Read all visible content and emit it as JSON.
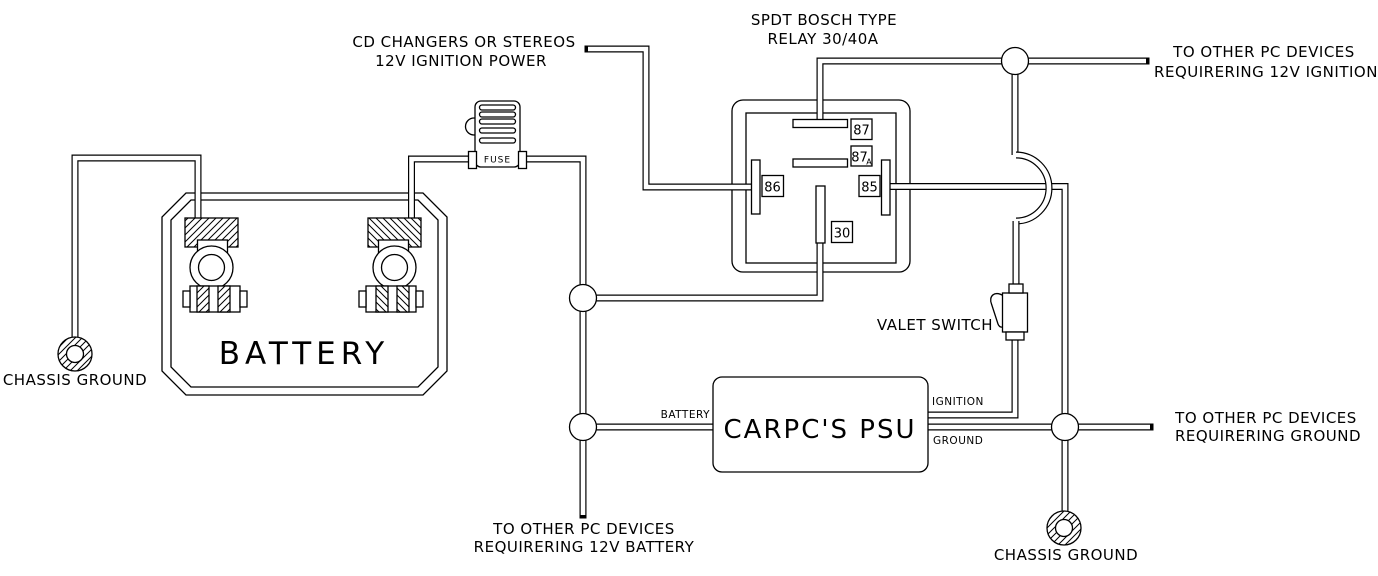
{
  "diagram": {
    "type": "car-pc-power-wiring-diagram",
    "background_color": "#ffffff",
    "line_color": "#000000"
  },
  "labels": {
    "cd_source_line1": "CD CHANGERS OR STEREOS",
    "cd_source_line2": "12V IGNITION POWER",
    "relay_title_line1": "SPDT BOSCH TYPE",
    "relay_title_line2": "RELAY 30/40A",
    "ignition_devices_line1": "TO OTHER PC DEVICES",
    "ignition_devices_line2": "REQUIRERING 12V IGNITION",
    "ground_devices_line1": "TO OTHER PC DEVICES",
    "ground_devices_line2": "REQUIRERING GROUND",
    "battery_devices_line1": "TO OTHER PC DEVICES",
    "battery_devices_line2": "REQUIRERING 12V BATTERY",
    "chassis_ground_left": "CHASSIS GROUND",
    "chassis_ground_right": "CHASSIS GROUND",
    "battery_label": "BATTERY",
    "fuse_label": "FUSE",
    "valet_switch_label": "VALET SWITCH",
    "psu_label": "CARPC'S PSU",
    "psu_battery_input": "BATTERY",
    "psu_ignition_output": "IGNITION",
    "psu_ground_output": "GROUND"
  },
  "relay": {
    "terminal_87": "87",
    "terminal_87a": "87",
    "terminal_87a_suffix": "A",
    "terminal_86": "86",
    "terminal_85": "85",
    "terminal_30": "30"
  }
}
